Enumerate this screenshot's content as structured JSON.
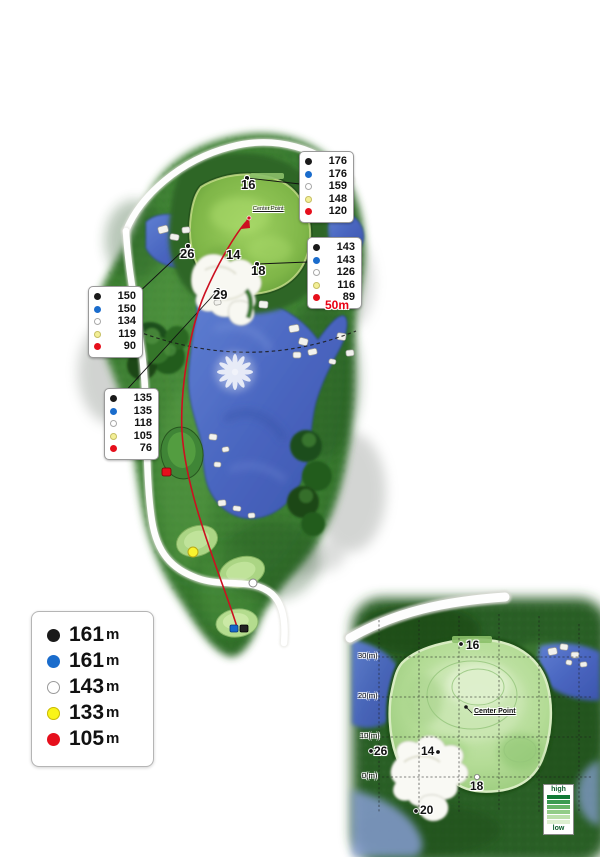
{
  "marker_colors": {
    "black": "#1a1a1a",
    "blue": "#1a6ccc",
    "white": "#ffffff",
    "yellow": "#f6f03a",
    "red": "#e80f1e"
  },
  "distance_boxes": [
    {
      "name": "green-back-distances",
      "rows": [
        {
          "dot": "black",
          "value": "176"
        },
        {
          "dot": "blue",
          "value": "176"
        },
        {
          "dot": "white",
          "value": "159"
        },
        {
          "dot": "yellow",
          "value": "148"
        },
        {
          "dot": "red",
          "value": "120"
        }
      ]
    },
    {
      "name": "green-front-distances",
      "rows": [
        {
          "dot": "black",
          "value": "143"
        },
        {
          "dot": "blue",
          "value": "143"
        },
        {
          "dot": "white",
          "value": "126"
        },
        {
          "dot": "yellow",
          "value": "116"
        },
        {
          "dot": "red",
          "value": "89"
        }
      ]
    },
    {
      "name": "left-distances",
      "rows": [
        {
          "dot": "black",
          "value": "150"
        },
        {
          "dot": "blue",
          "value": "150"
        },
        {
          "dot": "white",
          "value": "134"
        },
        {
          "dot": "yellow",
          "value": "119"
        },
        {
          "dot": "red",
          "value": "90"
        }
      ]
    },
    {
      "name": "lower-left-distances",
      "rows": [
        {
          "dot": "black",
          "value": "135"
        },
        {
          "dot": "blue",
          "value": "135"
        },
        {
          "dot": "white",
          "value": "118"
        },
        {
          "dot": "yellow",
          "value": "105"
        },
        {
          "dot": "red",
          "value": "76"
        }
      ]
    }
  ],
  "tee_legend": {
    "items": [
      {
        "dot": "black",
        "value": "161",
        "unit": "m"
      },
      {
        "dot": "blue",
        "value": "161",
        "unit": "m"
      },
      {
        "dot": "white",
        "value": "143",
        "unit": "m"
      },
      {
        "dot": "yellow",
        "value": "133",
        "unit": "m"
      },
      {
        "dot": "red",
        "value": "105",
        "unit": "m"
      }
    ]
  },
  "map_labels": {
    "green_back": "16",
    "green_left": "26",
    "green_mid": "14",
    "green_front": "18",
    "fairway": "29",
    "arc_distance": "50m",
    "center_point": "Center Point"
  },
  "green_inset": {
    "distance_axis": [
      {
        "label": "30(m)"
      },
      {
        "label": "20(m)"
      },
      {
        "label": "10(m)"
      },
      {
        "label": "0(m)"
      }
    ],
    "labels": {
      "back": "16",
      "left": "26",
      "mid": "14",
      "front": "18",
      "below": "20"
    },
    "center_point": "Center Point",
    "elevation_scale": {
      "high_label": "high",
      "low_label": "low",
      "colors": [
        "#117a36",
        "#3a9a50",
        "#66b468",
        "#92cc88",
        "#bce0ac",
        "#ddefd0"
      ]
    }
  }
}
